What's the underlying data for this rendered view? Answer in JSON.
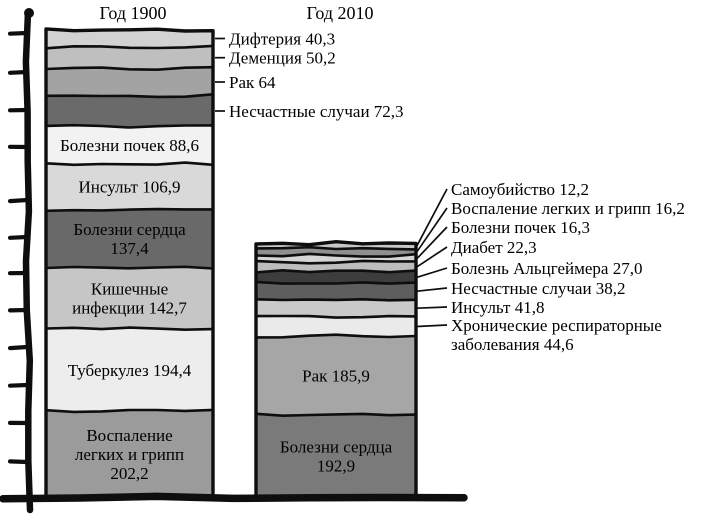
{
  "chart_data": {
    "type": "bar",
    "subtype": "stacked-column-comparison",
    "style": "hand-drawn grayscale book illustration",
    "layout_hints": {
      "orientation": "vertical",
      "grid": false,
      "y_tick_labels": "none (unlabeled tick marks on hand-drawn y-axis)",
      "value_format": "comma-decimal",
      "labels": "large segments labeled inside, small segments labeled with leader lines"
    },
    "bars": [
      {
        "title": "Год 1900",
        "total": 1099.0,
        "segments_top_to_bottom": [
          {
            "cause": "Дифтерия",
            "value": 40.3,
            "display": "Дифтерия 40,3",
            "color": "#d2d2d2",
            "label_mode": "leader"
          },
          {
            "cause": "Деменция",
            "value": 50.2,
            "display": "Деменция 50,2",
            "color": "#bfbfbf",
            "label_mode": "leader"
          },
          {
            "cause": "Рак",
            "value": 64,
            "display": "Рак 64",
            "color": "#a3a3a3",
            "label_mode": "leader"
          },
          {
            "cause": "Несчастные случаи",
            "value": 72.3,
            "display": "Несчастные случаи 72,3",
            "color": "#6a6a6a",
            "label_mode": "leader"
          },
          {
            "cause": "Болезни почек",
            "value": 88.6,
            "display": "Болезни почек 88,6",
            "display_lines": [
              "Болезни почек 88,6"
            ],
            "color": "#f2f2f2",
            "label_mode": "inside"
          },
          {
            "cause": "Инсульт",
            "value": 106.9,
            "display": "Инсульт 106,9",
            "display_lines": [
              "Инсульт 106,9"
            ],
            "color": "#d9d9d9",
            "label_mode": "inside"
          },
          {
            "cause": "Болезни сердца",
            "value": 137.4,
            "display": "Болезни сердца 137,4",
            "display_lines": [
              "Болезни сердца",
              "137,4"
            ],
            "color": "#696969",
            "label_mode": "inside"
          },
          {
            "cause": "Кишечные инфекции",
            "value": 142.7,
            "display": "Кишечные инфекции 142,7",
            "display_lines": [
              "Кишечные",
              "инфекции 142,7"
            ],
            "color": "#c6c6c6",
            "label_mode": "inside"
          },
          {
            "cause": "Туберкулез",
            "value": 194.4,
            "display": "Туберкулез 194,4",
            "display_lines": [
              "Туберкулез 194,4"
            ],
            "color": "#ededed",
            "label_mode": "inside"
          },
          {
            "cause": "Воспаление легких и грипп",
            "value": 202.2,
            "display": "Воспаление легких и грипп 202,2",
            "display_lines": [
              "Воспаление",
              "легких и грипп",
              "202,2"
            ],
            "color": "#9b9b9b",
            "label_mode": "inside"
          }
        ]
      },
      {
        "title": "Год 2010",
        "total": 597.4,
        "segments_top_to_bottom": [
          {
            "cause": "Самоубийство",
            "value": 12.2,
            "display": "Самоубийство 12,2",
            "color": "#c7c7c7",
            "label_mode": "leader"
          },
          {
            "cause": "Воспаление легких и грипп",
            "value": 16.2,
            "display": "Воспаление легких и грипп 16,2",
            "color": "#8f8f8f",
            "label_mode": "leader"
          },
          {
            "cause": "Болезни почек",
            "value": 16.3,
            "display": "Болезни почек 16,3",
            "color": "#d5d5d5",
            "label_mode": "leader"
          },
          {
            "cause": "Диабет",
            "value": 22.3,
            "display": "Диабет 22,3",
            "color": "#bdbdbd",
            "label_mode": "leader"
          },
          {
            "cause": "Болезнь Альцгеймера",
            "value": 27.0,
            "display": "Болезнь Альцгеймера 27,0",
            "color": "#3d3d3d",
            "label_mode": "leader"
          },
          {
            "cause": "Несчастные случаи",
            "value": 38.2,
            "display": "Несчастные случаи 38,2",
            "color": "#5e5e5e",
            "label_mode": "leader"
          },
          {
            "cause": "Инсульт",
            "value": 41.8,
            "display": "Инсульт 41,8",
            "color": "#c9c9c9",
            "label_mode": "leader"
          },
          {
            "cause": "Хронические респираторные заболевания",
            "value": 44.6,
            "display": "Хронические респираторные заболевания 44,6",
            "display_lines": [
              "Хронические респираторные",
              "заболевания 44,6"
            ],
            "color": "#eaeaea",
            "label_mode": "leader"
          },
          {
            "cause": "Рак",
            "value": 185.9,
            "display": "Рак 185,9",
            "display_lines": [
              "Рак 185,9"
            ],
            "color": "#a6a6a6",
            "label_mode": "inside"
          },
          {
            "cause": "Болезни сердца",
            "value": 192.9,
            "display": "Болезни сердца 192,9",
            "display_lines": [
              "Болезни сердца",
              "192,9"
            ],
            "color": "#7a7a7a",
            "label_mode": "inside"
          }
        ]
      }
    ]
  }
}
